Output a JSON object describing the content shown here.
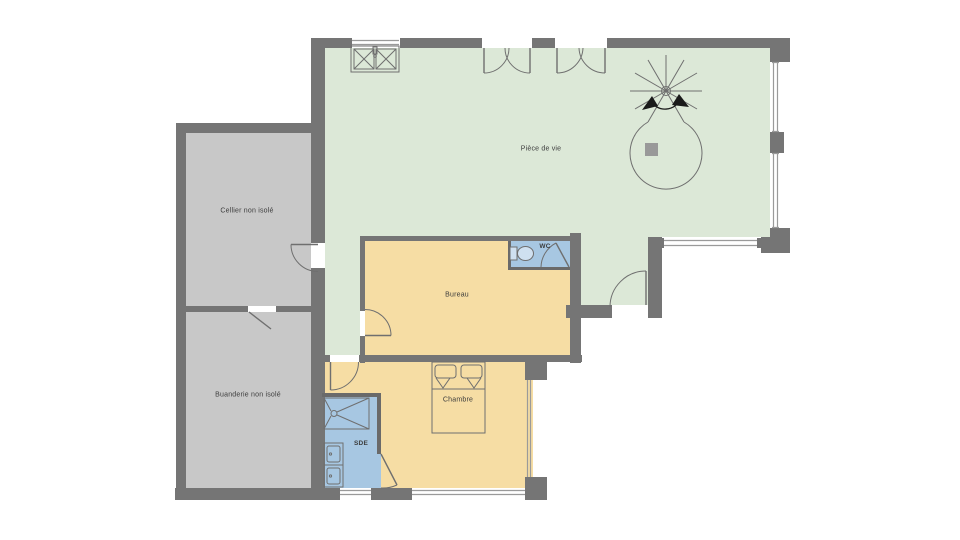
{
  "plan_title": "Floor plan - ground floor",
  "rooms": {
    "piece_de_vie": {
      "label": "Pièce de vie",
      "color": "#dce8d7"
    },
    "cellier": {
      "label": "Cellier non isolé",
      "color": "#c8c8c8"
    },
    "buanderie": {
      "label": "Buanderie non isolé",
      "color": "#c8c8c8"
    },
    "bureau": {
      "label": "Bureau",
      "color": "#f6dda4"
    },
    "wc": {
      "label": "WC",
      "color": "#a7c7e2"
    },
    "chambre": {
      "label": "Chambre",
      "color": "#f6dda4"
    },
    "sde": {
      "label": "SDE",
      "color": "#a7c7e2"
    },
    "hall": {
      "label": "",
      "color": "#dce8d7"
    }
  },
  "palette": {
    "wall": "#757575",
    "line": "#6a6a6a",
    "fixture_line": "#6f6f6f",
    "window_line": "#9a9a9a",
    "text": "#3c3c3c",
    "column": "#999999",
    "fixture_fill": "#cfe0f0",
    "background": "#ffffff"
  },
  "fixtures": [
    "double-sink",
    "spiral-staircase",
    "structural-column",
    "toilet",
    "double-bed",
    "shower",
    "double-vanity"
  ]
}
